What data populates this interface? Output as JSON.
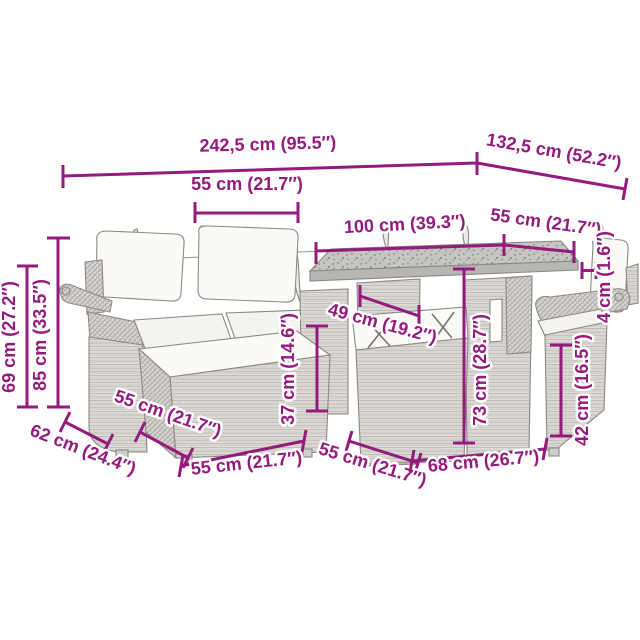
{
  "diagram": {
    "type": "product-dimension-diagram",
    "subject": "poly rattan garden lounge set with table, sofa, chair and ottomans",
    "accent_color": "#941a7d",
    "furniture_color": "#e2e0dc",
    "background_color": "#ffffff",
    "labels": {
      "overall_width": "242,5 cm (95.5″)",
      "overall_depth": "132,5 cm (52.2″)",
      "sofa_seat_width": "55 cm (21.7″)",
      "table_width": "100 cm (39.3″)",
      "chair_width": "55 cm (21.7″)",
      "tabletop_thickness": "4 cm (1.6″)",
      "under_table_clearance": "49 cm (19.2″)",
      "seat_height": "37 cm (14.6″)",
      "table_height": "73 cm (28.7″)",
      "chair_seat_height": "42 cm (16.5″)",
      "armrest_height": "69 cm (27.2″)",
      "total_height": "85 cm (33.5″)",
      "sofa_depth": "62 cm (24.4″)",
      "ottoman_depth": "55 cm (21.7″)",
      "ottoman_width": "55 cm (21.7″)",
      "under_table_ottoman_width": "55 cm (21.7″)",
      "table_depth": "68 cm (26.7″)"
    }
  }
}
